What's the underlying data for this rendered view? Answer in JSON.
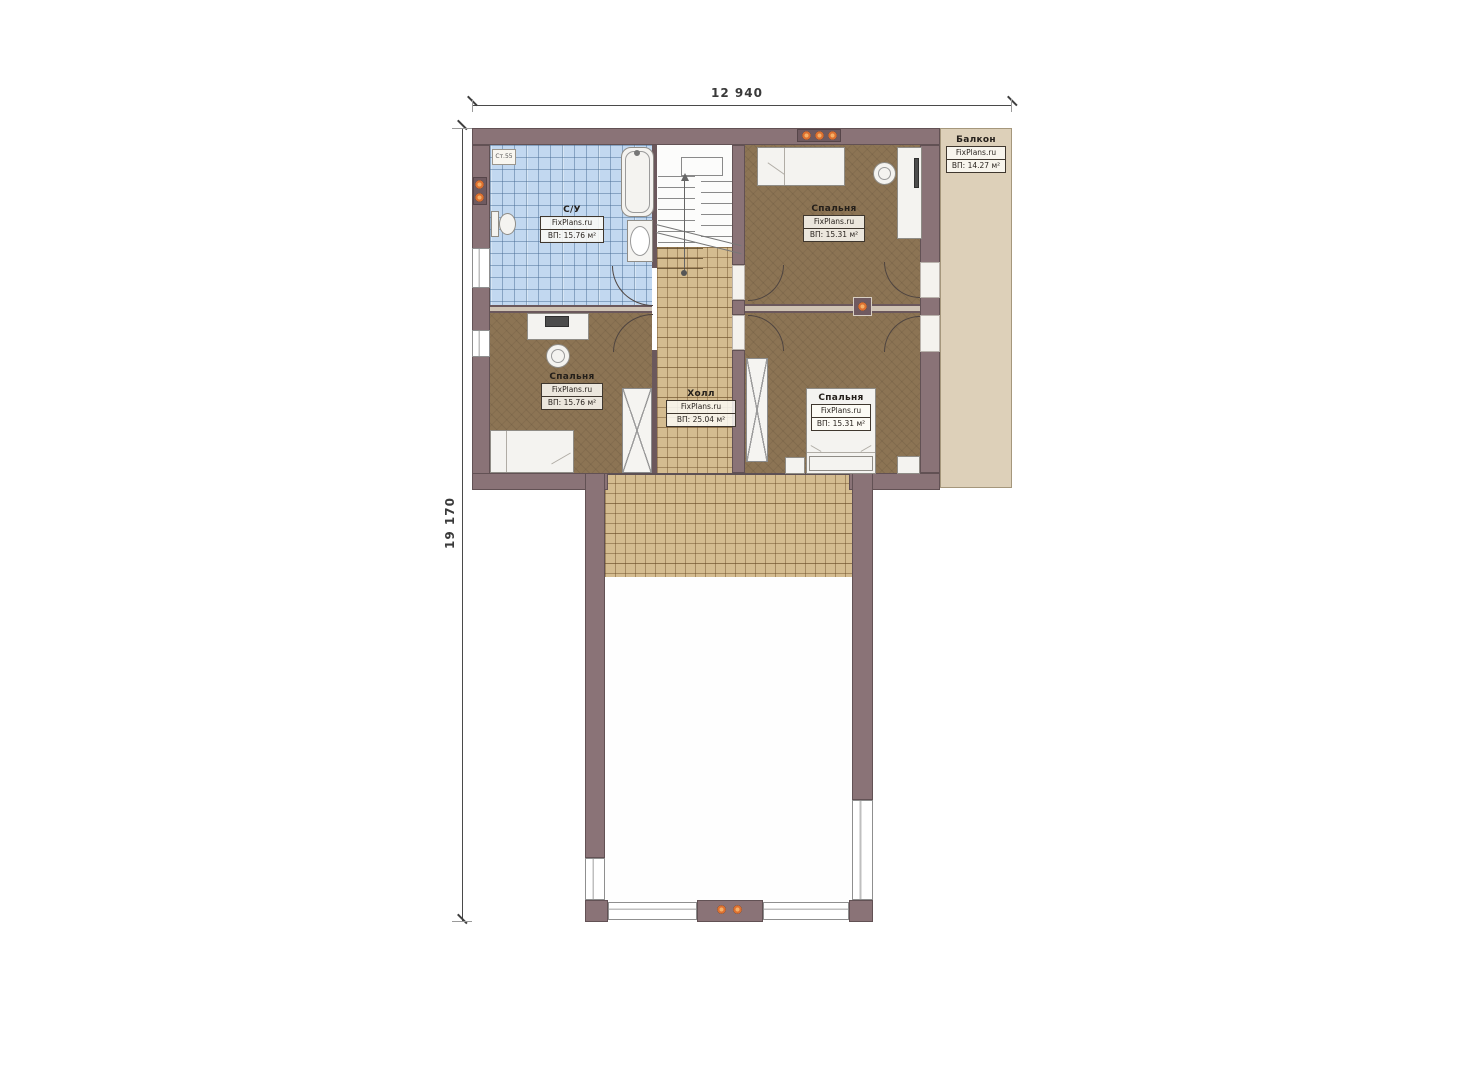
{
  "brand": "FixPlans.ru",
  "dimensions": {
    "top": "12 940",
    "left": "19 170"
  },
  "stamp": {
    "text": "Ст.55"
  },
  "rooms": [
    {
      "id": "bathroom",
      "name": "С/У",
      "brand": "FixPlans.ru",
      "area": "ВП: 15.76 м²"
    },
    {
      "id": "bedroom-top",
      "name": "Спальня",
      "brand": "FixPlans.ru",
      "area": "ВП: 15.31 м²"
    },
    {
      "id": "bedroom-left",
      "name": "Спальня",
      "brand": "FixPlans.ru",
      "area": "ВП: 15.76 м²"
    },
    {
      "id": "hall",
      "name": "Холл",
      "brand": "FixPlans.ru",
      "area": "ВП: 25.04 м²"
    },
    {
      "id": "bedroom-bottom",
      "name": "Спальня",
      "brand": "FixPlans.ru",
      "area": "ВП: 15.31 м²"
    },
    {
      "id": "balcony",
      "name": "Балкон",
      "brand": "FixPlans.ru",
      "area": "ВП: 14.27 м²"
    }
  ],
  "colors": {
    "wall": "#8a7377",
    "bathroom_tile": "#c2d8f0",
    "bedroom_floor": "#8c7454",
    "hall_tile": "#d4bc90",
    "balcony": "#ddd0b9",
    "accent_orange": "#dd7030"
  }
}
